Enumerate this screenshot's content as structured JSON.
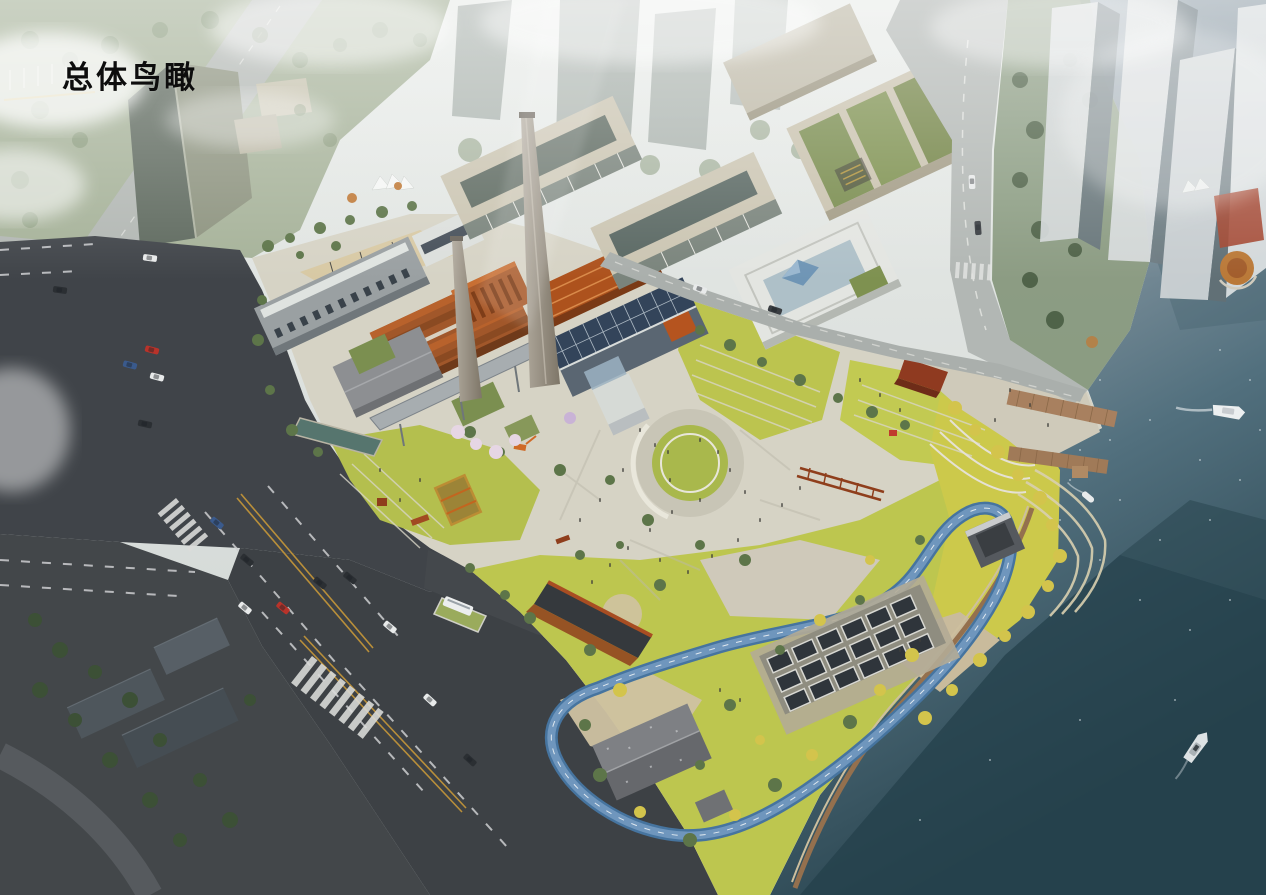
{
  "title": {
    "text": "总体鸟瞰"
  },
  "scene": {
    "type": "architectural-aerial-rendering",
    "description": "Bird's-eye masterplan rendering of a riverside industrial-heritage regeneration site: preserved power-plant buildings with twin smokestacks, new glass office blocks, a central circular plaza, a riverside park with a winding blue running track, piers and boats on the river, surrounded by city roads and high-rise towers.",
    "elements": [
      {
        "name": "view-title",
        "label": "总体鸟瞰"
      },
      {
        "name": "river",
        "label": "river with sparkling water and tower shadows"
      },
      {
        "name": "yacht-upper",
        "label": "white yacht"
      },
      {
        "name": "boat-small",
        "label": "small boat near dock"
      },
      {
        "name": "yacht-lower",
        "label": "yacht in dark water"
      },
      {
        "name": "piers",
        "label": "timber piers"
      },
      {
        "name": "chimney-main",
        "label": "tall power-plant chimney"
      },
      {
        "name": "chimney-secondary",
        "label": "secondary chimney"
      },
      {
        "name": "heritage-cluster",
        "label": "brick power-plant heritage buildings"
      },
      {
        "name": "solar-roof-hall",
        "label": "hall with photovoltaic roof"
      },
      {
        "name": "glass-office-a",
        "label": "glass office slab"
      },
      {
        "name": "glass-office-b",
        "label": "glass office slab"
      },
      {
        "name": "terraced-office",
        "label": "white terraced office with blue pyramid skylight"
      },
      {
        "name": "convention-center",
        "label": "beige halls with green roofs"
      },
      {
        "name": "circular-plaza",
        "label": "circular sunken lawn plaza"
      },
      {
        "name": "running-track",
        "label": "blue looping running track"
      },
      {
        "name": "pergola-grid",
        "label": "sunken skylight grid structure"
      },
      {
        "name": "stone-lodge",
        "label": "pitched-roof stone building"
      },
      {
        "name": "corten-ramp",
        "label": "corten-edged sunken ramp"
      },
      {
        "name": "towers-northeast",
        "label": "hazy high-rise towers"
      },
      {
        "name": "tower-northwest",
        "label": "office tower"
      },
      {
        "name": "dark-roads",
        "label": "asphalt arterial roads with lane markings"
      },
      {
        "name": "bus",
        "label": "white bus"
      },
      {
        "name": "cars",
        "label": "cars on roads"
      },
      {
        "name": "crosswalks",
        "label": "zebra crossings"
      },
      {
        "name": "ginkgo-shore",
        "label": "yellow ginkgo trees along waterfront"
      },
      {
        "name": "cherry-trees",
        "label": "blossom trees"
      },
      {
        "name": "haze",
        "label": "atmospheric haze and clouds"
      }
    ]
  },
  "palette": {
    "haze": "#e8ebe9",
    "asphalt": "#3f4347",
    "road_light": "#b2b7b4",
    "paving": "#d6d3c5",
    "lawn": "#b9c24e",
    "lawn_bright": "#ccc94b",
    "tree_green": "#5d7549",
    "ginkgo_yellow": "#d3c44c",
    "water_light": "#8e9ca6",
    "water_dark": "#2a4550",
    "track_blue": "#4a7aa8",
    "corten": "#a14a22",
    "brick": "#a1572a",
    "roof_orange": "#bf6128",
    "glass_dark": "#46554f",
    "building_white": "#e6e9e6",
    "beige": "#c9c2ae",
    "green_roof": "#7b8f50",
    "chimney_gray": "#a59e93",
    "boat_white": "#eef0f0"
  }
}
